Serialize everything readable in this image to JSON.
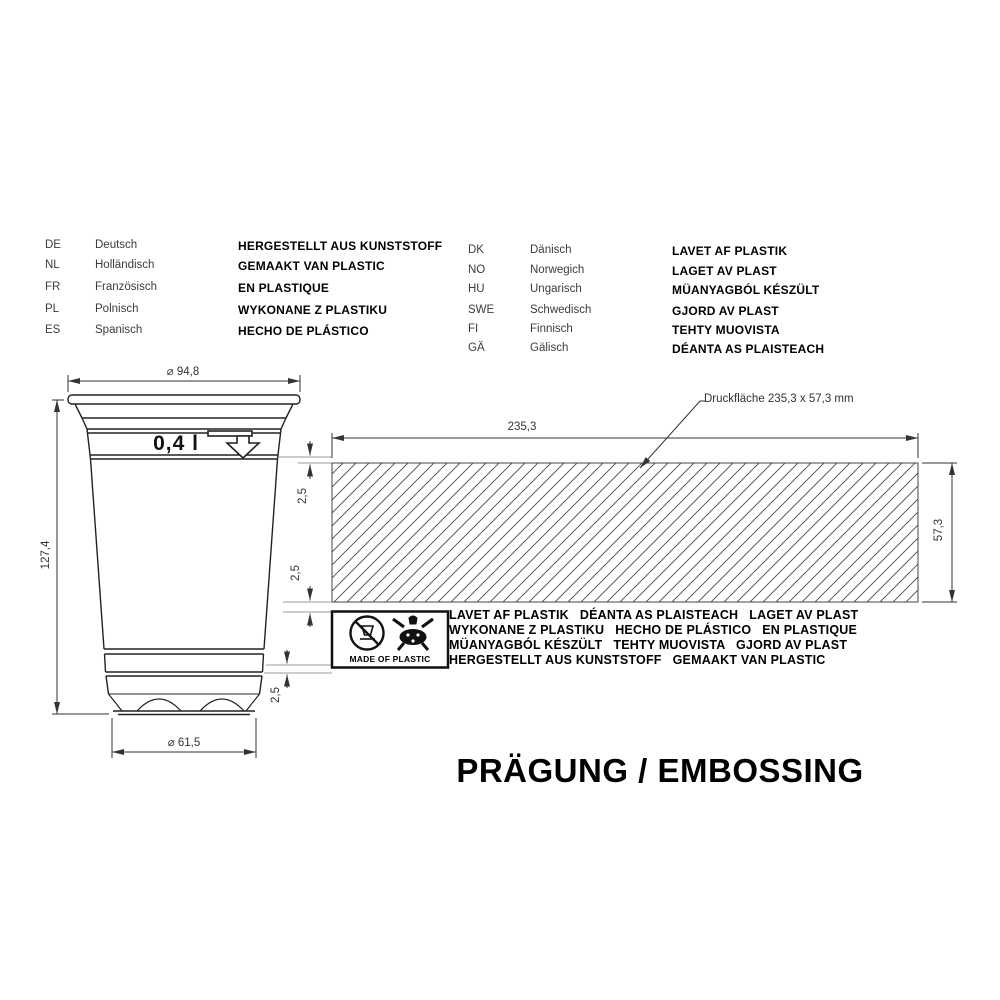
{
  "title": "PRÄGUNG / EMBOSSING",
  "language_table": {
    "left": [
      {
        "code": "DE",
        "language": "Deutsch",
        "text": "HERGESTELLT AUS KUNSTSTOFF"
      },
      {
        "code": "NL",
        "language": "Holländisch",
        "text": "GEMAAKT VAN PLASTIC"
      },
      {
        "code": "FR",
        "language": "Französisch",
        "text": "EN PLASTIQUE"
      },
      {
        "code": "PL",
        "language": "Polnisch",
        "text": "WYKONANE Z PLASTIKU"
      },
      {
        "code": "ES",
        "language": "Spanisch",
        "text": "HECHO DE PLÁSTICO"
      }
    ],
    "right": [
      {
        "code": "DK",
        "language": "Dänisch",
        "text": "LAVET AF PLASTIK"
      },
      {
        "code": "NO",
        "language": "Norwegich",
        "text": "LAGET AV PLAST"
      },
      {
        "code": "HU",
        "language": "Ungarisch",
        "text": "MÜANYAGBÓL KÉSZÜLT"
      },
      {
        "code": "SWE",
        "language": "Schwedisch",
        "text": "GJORD AV PLAST"
      },
      {
        "code": "FI",
        "language": "Finnisch",
        "text": "TEHTY MUOVISTA"
      },
      {
        "code": "GÄ",
        "language": "Gälisch",
        "text": "DÉANTA AS PLAISTEACH"
      }
    ]
  },
  "cup": {
    "volume_label": "0,4 l",
    "top_diameter": "⌀ 94,8",
    "height": "127,4",
    "bottom_diameter": "⌀ 61,5"
  },
  "print_area": {
    "label": "Druckfläche 235,3 x 57,3 mm",
    "width": "235,3",
    "height": "57,3",
    "offset_top": "2,5",
    "offset_middle": "2,5",
    "offset_bottom": "2,5"
  },
  "embossing": {
    "made_of_plastic": "MADE OF PLASTIC",
    "lines": [
      "LAVET AF PLASTIK   DÉANTA AS PLAISTEACH   LAGET AV PLAST",
      "WYKONANE Z PLASTIKU   HECHO DE PLÁSTICO   EN PLASTIQUE",
      "MÜANYAGBÓL KÉSZÜLT   TEHTY MUOVISTA   GJORD AV PLAST",
      "HERGESTELLT AUS KUNSTSTOFF   GEMAAKT VAN PLASTIC"
    ]
  },
  "colors": {
    "line": "#333333",
    "text": "#000000",
    "background": "#ffffff"
  }
}
